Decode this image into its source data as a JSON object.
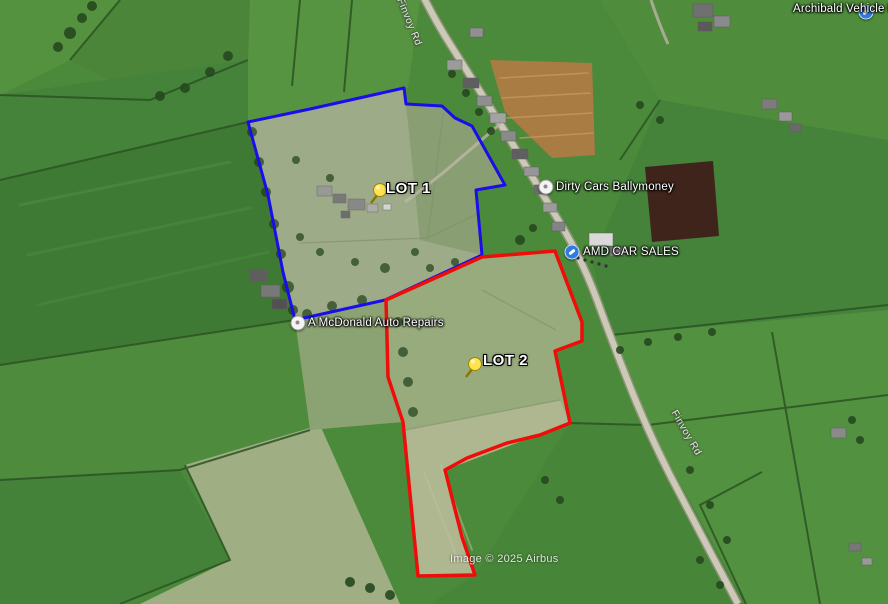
{
  "map": {
    "attribution": "Image © 2025 Airbus",
    "attribution_pos": {
      "x": 450,
      "y": 553
    },
    "lots": [
      {
        "id": "lot-1",
        "label": "LOT 1",
        "color": "#1a0deb",
        "stroke_width": 3,
        "points": [
          [
            248,
            122
          ],
          [
            310,
            109
          ],
          [
            404,
            88
          ],
          [
            406,
            104
          ],
          [
            442,
            106
          ],
          [
            455,
            118
          ],
          [
            472,
            126
          ],
          [
            505,
            185
          ],
          [
            476,
            190
          ],
          [
            482,
            255
          ],
          [
            385,
            300
          ],
          [
            295,
            320
          ],
          [
            283,
            272
          ],
          [
            268,
            195
          ]
        ],
        "pin": {
          "x": 371,
          "y": 203
        },
        "label_pos": {
          "x": 386,
          "y": 180
        }
      },
      {
        "id": "lot-2",
        "label": "LOT 2",
        "color": "#ee0d09",
        "stroke_width": 3.5,
        "points": [
          [
            555,
            251
          ],
          [
            582,
            322
          ],
          [
            582,
            341
          ],
          [
            555,
            351
          ],
          [
            570,
            423
          ],
          [
            540,
            435
          ],
          [
            507,
            443
          ],
          [
            467,
            458
          ],
          [
            445,
            470
          ],
          [
            462,
            537
          ],
          [
            475,
            575
          ],
          [
            418,
            576
          ],
          [
            403,
            422
          ],
          [
            388,
            377
          ],
          [
            386,
            300
          ],
          [
            482,
            257
          ]
        ],
        "pin": {
          "x": 466,
          "y": 377
        },
        "label_pos": {
          "x": 483,
          "y": 352
        }
      }
    ],
    "markers": [
      {
        "id": "archibald",
        "label": "Archibald Vehicle Repa",
        "icon": "wrench-blue",
        "x": 866,
        "y": 12,
        "label_x": 793,
        "label_y": 3
      },
      {
        "id": "dirty-cars",
        "label": "Dirty Cars Ballymoney",
        "icon": "dot-white",
        "x": 546,
        "y": 187,
        "label_x": 556,
        "label_y": 181
      },
      {
        "id": "amd-car-sales",
        "label": "AMD CAR SALES",
        "icon": "wrench-blue",
        "x": 572,
        "y": 252,
        "label_x": 583,
        "label_y": 246
      },
      {
        "id": "a-mcdonald",
        "label": "A McDonald Auto Repairs",
        "icon": "dot-white",
        "x": 298,
        "y": 323,
        "label_x": 308,
        "label_y": 317
      }
    ],
    "road_labels": [
      {
        "text": "Finvoy Rd",
        "x": 409,
        "y": 22,
        "rotation": 68
      },
      {
        "text": "Finvoy Rd",
        "x": 686,
        "y": 433,
        "rotation": 60
      }
    ]
  }
}
